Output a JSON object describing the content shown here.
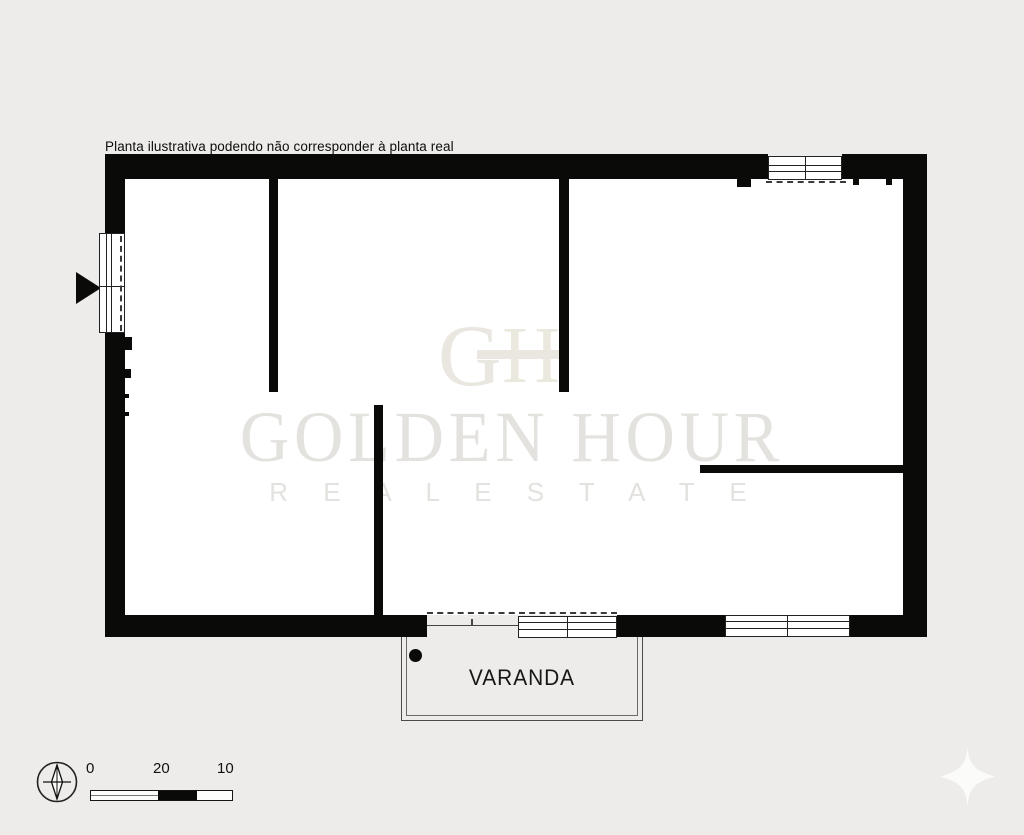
{
  "disclaimer": "Planta ilustrativa podendo não corresponder à planta real",
  "watermark": {
    "monogram": {
      "g": "G",
      "h": "H"
    },
    "title": "GOLDEN HOUR",
    "subtitle": "R E A L   E S T A T E"
  },
  "plan": {
    "balcony_label": "VARANDA"
  },
  "scale_bar": {
    "labels": [
      "0",
      "20",
      "10"
    ]
  },
  "icons": {
    "compass": "compass-north-icon",
    "entrance": "entrance-arrow-icon",
    "sparkle": "sparkle-icon"
  },
  "colors": {
    "background": "#edecea",
    "wall": "#0a0a09",
    "plan_interior": "#ffffff",
    "watermark": "#e5e3df",
    "label_text": "#111111"
  }
}
